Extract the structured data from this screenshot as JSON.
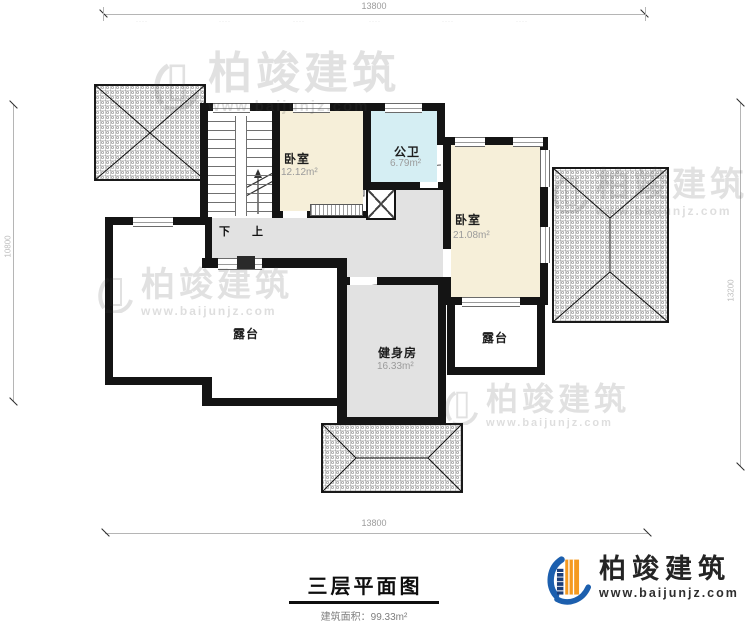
{
  "title_block": {
    "title": "三层平面图",
    "area_label": "建筑面积：99.33m²"
  },
  "logo": {
    "name": "柏竣建筑",
    "url": "www.baijunjz.com"
  },
  "watermark": {
    "name": "柏竣建筑",
    "url": "www.baijunjz.com"
  },
  "dimensions": {
    "top": "13800",
    "bottom": "13800",
    "left": "10800",
    "right": "13200",
    "top_segments": [
      "····",
      "····",
      "····",
      "····",
      "····",
      "····"
    ]
  },
  "stairs": {
    "down": "下",
    "up": "上"
  },
  "rooms": {
    "bedroom1": {
      "name": "卧室",
      "area": "12.12m²"
    },
    "bathroom": {
      "name": "公卫",
      "area": "6.79m²"
    },
    "bedroom2": {
      "name": "卧室",
      "area": "21.08m²"
    },
    "gym": {
      "name": "健身房",
      "area": "16.33m²"
    },
    "terrace_left": {
      "name": "露台"
    },
    "terrace_right": {
      "name": "露台"
    }
  },
  "colors": {
    "wall": "#141414",
    "bedroom_fill": "#f6efd9",
    "bath_fill": "#d5eef3",
    "hall_fill": "#e2e2e2",
    "logo_blue": "#1c5fae",
    "logo_orange": "#f59a20"
  }
}
